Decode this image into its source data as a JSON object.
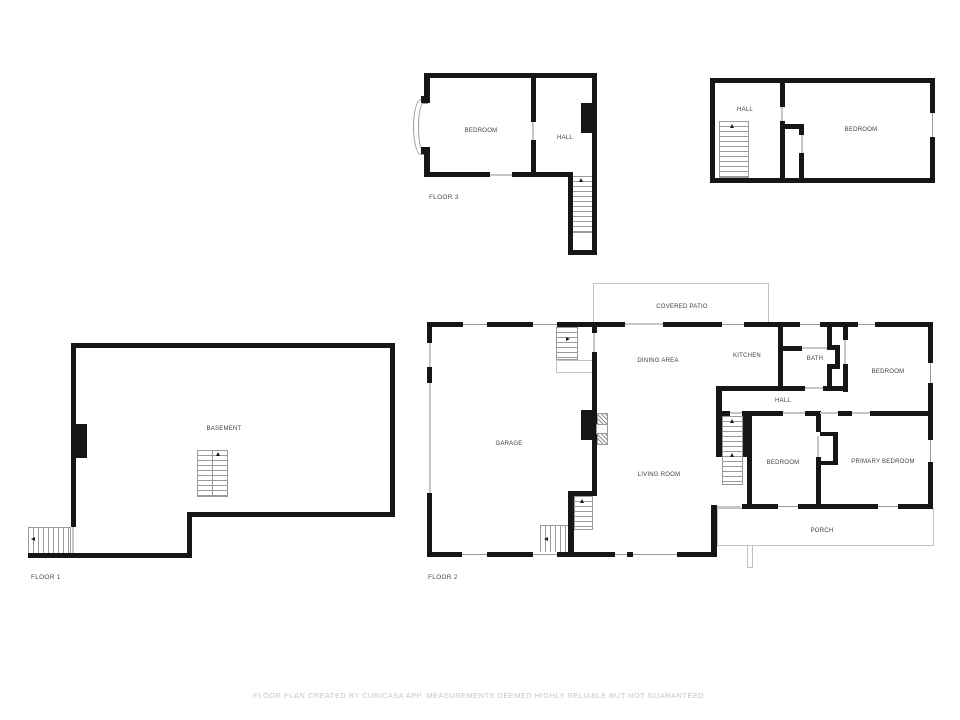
{
  "footer": {
    "disclaimer": "FLOOR PLAN CREATED BY CUBICASA APP. MEASUREMENTS DEEMED HIGHLY RELIABLE BUT NOT GUARANTEED."
  },
  "colors": {
    "wall": "#161616",
    "thin_outline": "#c2c2c2",
    "stair_tread": "#9a9a9a",
    "room_label": "#3f3f3f",
    "floor_label": "#4a4a4a",
    "footer_text": "#c6c6c6",
    "background": "#ffffff"
  },
  "floors": [
    {
      "name": "floor-3-left",
      "floor_label": {
        "text": "FLOOR 3",
        "x": 429,
        "y": 194
      },
      "rooms": [
        {
          "id": "f3-bedroom",
          "text": "BEDROOM",
          "x": 481,
          "y": 131
        },
        {
          "id": "f3-hall",
          "text": "HALL",
          "x": 565,
          "y": 138
        }
      ],
      "walls": [
        [
          424,
          73,
          173,
          5
        ],
        [
          424,
          73,
          6,
          28
        ],
        [
          421,
          96,
          9,
          7
        ],
        [
          421,
          147,
          9,
          7
        ],
        [
          424,
          152,
          6,
          25
        ],
        [
          424,
          172,
          66,
          5
        ],
        [
          512,
          172,
          58,
          5
        ],
        [
          531,
          77,
          5,
          45
        ],
        [
          531,
          140,
          5,
          37
        ],
        [
          568,
          172,
          5,
          83
        ],
        [
          592,
          73,
          5,
          182
        ],
        [
          568,
          250,
          29,
          5
        ],
        [
          581,
          103,
          12,
          30
        ]
      ],
      "windows": [
        [
          494,
          73,
          18,
          5,
          "h"
        ]
      ],
      "doors": [
        [
          490,
          174,
          22,
          2
        ],
        [
          532,
          122,
          2,
          18
        ]
      ],
      "arcs": [
        [
          413,
          99,
          16,
          56
        ],
        [
          418,
          103,
          10,
          48
        ]
      ],
      "stairs": [
        [
          572,
          176,
          21,
          57,
          "v"
        ]
      ],
      "arrows": [
        [
          579,
          178,
          "up"
        ]
      ]
    },
    {
      "name": "floor-3-right",
      "rooms": [
        {
          "id": "f3b-hall",
          "text": "HALL",
          "x": 745,
          "y": 110
        },
        {
          "id": "f3b-bedroom",
          "text": "BEDROOM",
          "x": 861,
          "y": 130
        }
      ],
      "walls": [
        [
          710,
          78,
          225,
          5
        ],
        [
          710,
          178,
          225,
          5
        ],
        [
          710,
          78,
          5,
          105
        ],
        [
          930,
          78,
          5,
          35
        ],
        [
          930,
          137,
          5,
          46
        ],
        [
          780,
          83,
          5,
          24
        ],
        [
          780,
          121,
          5,
          57
        ],
        [
          780,
          124,
          24,
          5
        ],
        [
          799,
          124,
          5,
          11
        ],
        [
          799,
          153,
          5,
          25
        ]
      ],
      "windows": [
        [
          930,
          113,
          5,
          24,
          "v"
        ]
      ],
      "doors": [
        [
          781,
          107,
          2,
          14
        ],
        [
          801,
          135,
          2,
          18
        ]
      ],
      "stairs": [
        [
          719,
          121,
          30,
          57,
          "v"
        ]
      ],
      "arrows": [
        [
          730,
          124,
          "up"
        ]
      ]
    },
    {
      "name": "floor-1",
      "floor_label": {
        "text": "FLOOR 1",
        "x": 31,
        "y": 574
      },
      "rooms": [
        {
          "id": "basement",
          "text": "BASEMENT",
          "x": 224,
          "y": 429
        }
      ],
      "walls": [
        [
          71,
          343,
          324,
          5
        ],
        [
          71,
          343,
          5,
          184
        ],
        [
          390,
          343,
          5,
          174
        ],
        [
          187,
          512,
          208,
          5
        ],
        [
          187,
          512,
          5,
          46
        ],
        [
          28,
          553,
          164,
          5
        ],
        [
          71,
          424,
          16,
          34
        ]
      ],
      "windows": [
        [
          95,
          343,
          21,
          5,
          "h"
        ]
      ],
      "doors": [
        [
          72,
          527,
          2,
          26
        ]
      ],
      "stairs": [
        [
          28,
          527,
          43,
          27,
          "h"
        ],
        [
          197,
          450,
          16,
          47,
          "v"
        ],
        [
          212,
          450,
          16,
          47,
          "v"
        ]
      ],
      "arrows": [
        [
          31,
          537,
          "left"
        ],
        [
          216,
          452,
          "up"
        ]
      ]
    },
    {
      "name": "floor-2",
      "floor_label": {
        "text": "FLOOR 2",
        "x": 428,
        "y": 574
      },
      "rooms": [
        {
          "id": "covered-patio",
          "text": "COVERED PATIO",
          "x": 682,
          "y": 307
        },
        {
          "id": "garage",
          "text": "GARAGE",
          "x": 509,
          "y": 444
        },
        {
          "id": "dining-area",
          "text": "DINING AREA",
          "x": 658,
          "y": 361
        },
        {
          "id": "kitchen",
          "text": "KITCHEN",
          "x": 747,
          "y": 356
        },
        {
          "id": "bath",
          "text": "BATH",
          "x": 815,
          "y": 359
        },
        {
          "id": "hall",
          "text": "HALL",
          "x": 783,
          "y": 401
        },
        {
          "id": "bedroom-top",
          "text": "BEDROOM",
          "x": 888,
          "y": 372
        },
        {
          "id": "bedroom-mid",
          "text": "BEDROOM",
          "x": 783,
          "y": 463
        },
        {
          "id": "primary-bedroom",
          "text": "PRIMARY BEDROOM",
          "x": 883,
          "y": 462
        },
        {
          "id": "living-room",
          "text": "LIVING ROOM",
          "x": 659,
          "y": 475
        },
        {
          "id": "porch",
          "text": "PORCH",
          "x": 822,
          "y": 531
        }
      ],
      "thins": [
        [
          593,
          283,
          176,
          42
        ],
        [
          556,
          360,
          38,
          13
        ],
        [
          717,
          508,
          217,
          38
        ],
        [
          747,
          545,
          6,
          23
        ]
      ],
      "walls": [
        [
          427,
          322,
          36,
          5
        ],
        [
          487,
          322,
          46,
          5
        ],
        [
          557,
          322,
          68,
          5
        ],
        [
          663,
          322,
          59,
          5
        ],
        [
          744,
          322,
          56,
          5
        ],
        [
          820,
          322,
          38,
          5
        ],
        [
          875,
          322,
          58,
          5
        ],
        [
          427,
          322,
          5,
          21
        ],
        [
          427,
          367,
          5,
          16
        ],
        [
          427,
          493,
          5,
          64
        ],
        [
          427,
          552,
          35,
          5
        ],
        [
          487,
          552,
          46,
          5
        ],
        [
          557,
          552,
          58,
          5
        ],
        [
          627,
          552,
          6,
          5
        ],
        [
          677,
          552,
          40,
          5
        ],
        [
          711,
          505,
          6,
          52
        ],
        [
          742,
          504,
          36,
          5
        ],
        [
          798,
          504,
          80,
          5
        ],
        [
          898,
          504,
          35,
          5
        ],
        [
          928,
          322,
          5,
          41
        ],
        [
          928,
          383,
          5,
          57
        ],
        [
          928,
          462,
          5,
          47
        ],
        [
          592,
          327,
          5,
          6
        ],
        [
          592,
          352,
          5,
          143
        ],
        [
          581,
          410,
          12,
          30
        ],
        [
          778,
          322,
          5,
          69
        ],
        [
          778,
          346,
          24,
          5
        ],
        [
          827,
          322,
          5,
          27
        ],
        [
          827,
          345,
          13,
          5
        ],
        [
          835,
          349,
          5,
          19
        ],
        [
          827,
          364,
          13,
          5
        ],
        [
          827,
          369,
          5,
          20
        ],
        [
          843,
          322,
          5,
          18
        ],
        [
          843,
          364,
          5,
          28
        ],
        [
          717,
          386,
          88,
          5
        ],
        [
          823,
          386,
          25,
          5
        ],
        [
          717,
          411,
          13,
          5
        ],
        [
          742,
          411,
          41,
          5
        ],
        [
          805,
          411,
          15,
          5
        ],
        [
          838,
          411,
          14,
          5
        ],
        [
          870,
          411,
          63,
          5
        ],
        [
          716,
          386,
          6,
          71
        ],
        [
          743,
          416,
          5,
          41
        ],
        [
          747,
          411,
          5,
          94
        ],
        [
          816,
          411,
          5,
          21
        ],
        [
          816,
          457,
          5,
          48
        ],
        [
          820,
          432,
          18,
          4
        ],
        [
          833,
          432,
          5,
          33
        ],
        [
          820,
          461,
          18,
          4
        ],
        [
          568,
          491,
          29,
          5
        ],
        [
          568,
          491,
          6,
          66
        ]
      ],
      "windows": [
        [
          463,
          322,
          24,
          5,
          "h"
        ],
        [
          533,
          322,
          24,
          5,
          "h"
        ],
        [
          722,
          322,
          22,
          5,
          "h"
        ],
        [
          800,
          322,
          20,
          5,
          "h"
        ],
        [
          858,
          322,
          17,
          5,
          "h"
        ],
        [
          462,
          552,
          25,
          5,
          "h"
        ],
        [
          533,
          552,
          24,
          5,
          "h"
        ],
        [
          615,
          552,
          62,
          5,
          "h"
        ],
        [
          778,
          504,
          20,
          5,
          "h"
        ],
        [
          878,
          504,
          20,
          5,
          "h"
        ],
        [
          928,
          363,
          5,
          20,
          "v"
        ],
        [
          928,
          440,
          5,
          22,
          "v"
        ]
      ],
      "doors": [
        [
          625,
          323,
          38,
          2
        ],
        [
          429,
          343,
          2,
          24
        ],
        [
          429,
          383,
          2,
          110
        ],
        [
          593,
          333,
          2,
          19
        ],
        [
          802,
          347,
          25,
          2
        ],
        [
          844,
          340,
          2,
          24
        ],
        [
          805,
          387,
          18,
          2
        ],
        [
          730,
          412,
          12,
          2
        ],
        [
          783,
          412,
          22,
          2
        ],
        [
          820,
          412,
          18,
          2
        ],
        [
          852,
          412,
          18,
          2
        ],
        [
          817,
          436,
          2,
          21
        ],
        [
          717,
          506,
          24,
          2
        ]
      ],
      "hatches": [
        [
          597,
          413,
          11,
          12
        ],
        [
          597,
          433,
          11,
          12
        ]
      ],
      "whites": [
        [
          596,
          424,
          12,
          10
        ]
      ],
      "stairs": [
        [
          556,
          327,
          22,
          33,
          "v"
        ],
        [
          722,
          416,
          21,
          69,
          "v"
        ],
        [
          574,
          496,
          19,
          34,
          "v"
        ],
        [
          540,
          525,
          30,
          28,
          "h"
        ]
      ],
      "arrows": [
        [
          566,
          337,
          "right"
        ],
        [
          730,
          419,
          "up"
        ],
        [
          730,
          453,
          "up"
        ],
        [
          580,
          499,
          "up"
        ],
        [
          544,
          537,
          "left"
        ]
      ]
    }
  ]
}
